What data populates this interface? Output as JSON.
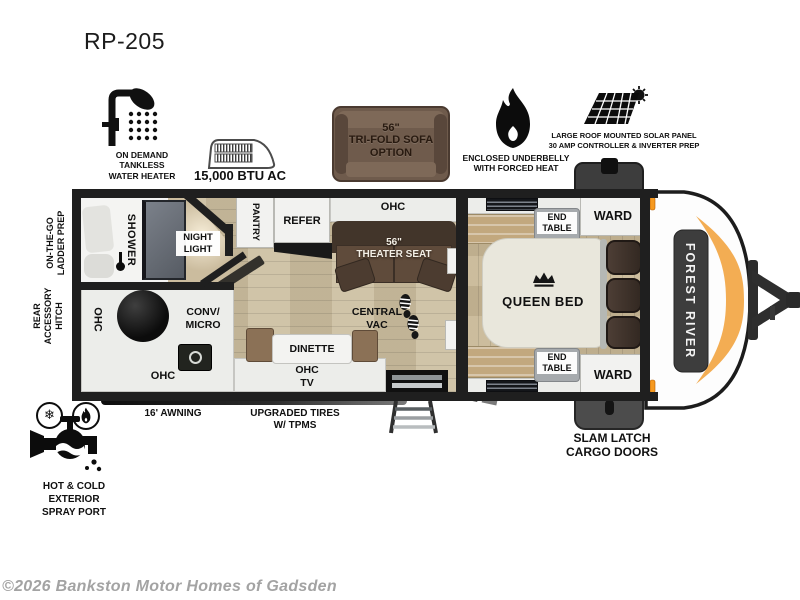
{
  "title": "RP-205",
  "features": {
    "water_heater": "ON DEMAND\nTANKLESS\nWATER HEATER",
    "ac": "15,000 BTU AC",
    "sofa": "56\"\nTRI-FOLD SOFA\nOPTION",
    "underbelly": "ENCLOSED UNDERBELLY\nWITH FORCED HEAT",
    "solar": "LARGE ROOF MOUNTED SOLAR PANEL\n30 AMP CONTROLLER & INVERTER PREP",
    "spray_port": "HOT & COLD EXTERIOR\nSPRAY PORT"
  },
  "exterior": {
    "ladder_prep": "ON-THE-GO\nLADDER PREP",
    "rear_hitch": "REAR\nACCESSORY\nHITCH",
    "awning": "16' AWNING",
    "tires": "UPGRADED TIRES\nW/ TPMS",
    "cargo_doors": "SLAM LATCH\nCARGO DOORS",
    "brand": "FOREST RIVER"
  },
  "interior": {
    "shower": "SHOWER",
    "night_light": "NIGHT\nLIGHT",
    "pantry": "PANTRY",
    "refer": "REFER",
    "ohc": "OHC",
    "theater_seat": "56\"\nTHEATER SEAT",
    "conv_micro": "CONV/\nMICRO",
    "central_vac": "CENTRAL\nVAC",
    "dinette": "DINETTE",
    "ohc_tv": "OHC\nTV",
    "queen_bed": "QUEEN BED",
    "end_table": "END\nTABLE",
    "ward": "WARD"
  },
  "icons": {
    "snowflake": "❄"
  },
  "colors": {
    "wall": "#1f1f1f",
    "floor_wood": "#cbbd9e",
    "theater_brown": "#5f4b3b",
    "accent_orange": "#f2a440",
    "marker_orange": "#f6991f"
  },
  "footer": {
    "copyright": "©2026 Bankston Motor Homes of Gadsden"
  }
}
